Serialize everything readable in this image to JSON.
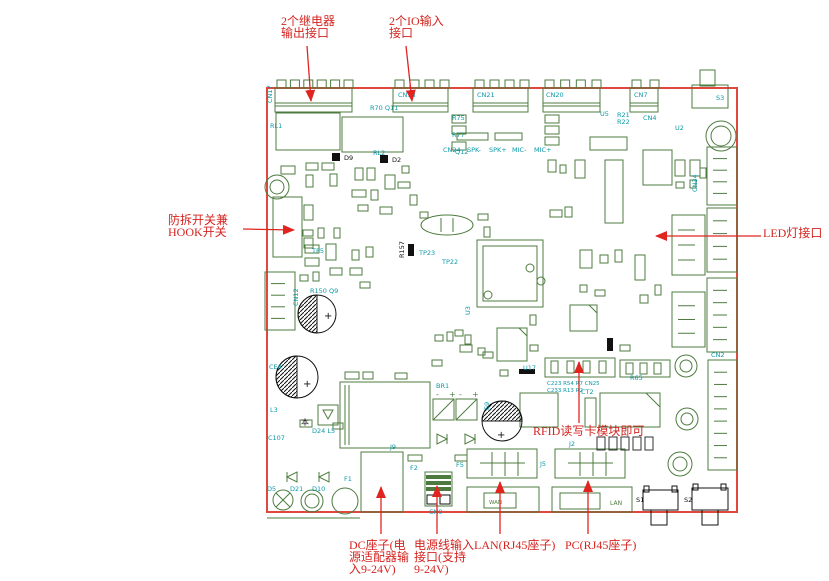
{
  "title": "PCB接口说明图",
  "colors": {
    "annotation_red": "#d42420",
    "board_outline_red": "#e0483e",
    "component_green": "#4d7b3f",
    "designator_cyan": "#0a98a8",
    "component_black": "#111111"
  },
  "annotations": [
    {
      "id": "relay-output",
      "lines": [
        "2个继电器",
        "输出接口"
      ],
      "x": 281,
      "y": 14,
      "arrow": {
        "x1": 307,
        "y1": 46,
        "x2": 311,
        "y2": 101
      }
    },
    {
      "id": "io-input",
      "lines": [
        "2个IO输入",
        "接口"
      ],
      "x": 389,
      "y": 14,
      "arrow": {
        "x1": 406,
        "y1": 46,
        "x2": 412,
        "y2": 101
      }
    },
    {
      "id": "tamper-hook-switch",
      "lines": [
        "防拆开关兼",
        "HOOK开关"
      ],
      "x": 168,
      "y": 213,
      "arrow": {
        "x1": 243,
        "y1": 229,
        "x2": 294,
        "y2": 230
      }
    },
    {
      "id": "led-port",
      "lines": [
        "LED灯接口"
      ],
      "x": 763,
      "y": 226,
      "arrow": {
        "x1": 761,
        "y1": 236,
        "x2": 656,
        "y2": 236
      }
    },
    {
      "id": "rfid-module",
      "lines": [
        "RFID读写卡模块即可"
      ],
      "x": 533,
      "y": 424,
      "arrow": {
        "x1": 579,
        "y1": 423,
        "x2": 579,
        "y2": 362
      }
    },
    {
      "id": "dc-jack",
      "lines": [
        "DC座子(电",
        "源适配器输",
        "入9-24V)"
      ],
      "x": 349,
      "y": 538,
      "arrow": {
        "x1": 381,
        "y1": 534,
        "x2": 381,
        "y2": 487
      }
    },
    {
      "id": "power-wire-input",
      "lines": [
        "电源线输入",
        "接口(支持",
        "9-24V)"
      ],
      "x": 414,
      "y": 538,
      "arrow": {
        "x1": 437,
        "y1": 534,
        "x2": 437,
        "y2": 486
      }
    },
    {
      "id": "lan-rj45",
      "lines": [
        "LAN(RJ45座子)"
      ],
      "x": 474,
      "y": 538,
      "arrow": {
        "x1": 500,
        "y1": 534,
        "x2": 500,
        "y2": 482
      }
    },
    {
      "id": "pc-rj45",
      "lines": [
        "PC(RJ45座子)"
      ],
      "x": 565,
      "y": 538,
      "arrow": {
        "x1": 588,
        "y1": 534,
        "x2": 588,
        "y2": 481
      }
    }
  ],
  "ref_labels": [
    {
      "t": "CN17",
      "x": 272,
      "y": 103,
      "r": -90
    },
    {
      "t": "CN18",
      "x": 398,
      "y": 97
    },
    {
      "t": "CN21",
      "x": 477,
      "y": 97
    },
    {
      "t": "CN20",
      "x": 546,
      "y": 97
    },
    {
      "t": "CN7",
      "x": 634,
      "y": 97
    },
    {
      "t": "S3",
      "x": 716,
      "y": 100
    },
    {
      "t": "R70 Q11",
      "x": 370,
      "y": 110
    },
    {
      "t": "RL1",
      "x": 270,
      "y": 128
    },
    {
      "t": "RL2",
      "x": 373,
      "y": 155
    },
    {
      "t": "R75",
      "x": 452,
      "y": 120
    },
    {
      "t": "R77",
      "x": 452,
      "y": 137
    },
    {
      "t": "Q12",
      "x": 455,
      "y": 154
    },
    {
      "t": "CN24",
      "x": 443,
      "y": 152
    },
    {
      "t": "SPK-",
      "x": 467,
      "y": 152
    },
    {
      "t": "SPK+",
      "x": 489,
      "y": 152
    },
    {
      "t": "MIC-",
      "x": 512,
      "y": 152
    },
    {
      "t": "MIC+",
      "x": 534,
      "y": 152
    },
    {
      "t": "U5",
      "x": 600,
      "y": 116
    },
    {
      "t": "R21",
      "x": 617,
      "y": 117
    },
    {
      "t": "R22",
      "x": 617,
      "y": 124
    },
    {
      "t": "CN4",
      "x": 643,
      "y": 120
    },
    {
      "t": "U2",
      "x": 675,
      "y": 130
    },
    {
      "t": "CN34",
      "x": 697,
      "y": 192,
      "r": -90
    },
    {
      "t": "TP5",
      "x": 312,
      "y": 253
    },
    {
      "t": "CN12",
      "x": 298,
      "y": 306,
      "r": -90
    },
    {
      "t": "R150 Q9",
      "x": 310,
      "y": 293
    },
    {
      "t": "CE4",
      "x": 269,
      "y": 369
    },
    {
      "t": "L3",
      "x": 270,
      "y": 412
    },
    {
      "t": "C107",
      "x": 268,
      "y": 440
    },
    {
      "t": "D24 L5",
      "x": 312,
      "y": 433
    },
    {
      "t": "D5",
      "x": 267,
      "y": 491
    },
    {
      "t": "D21",
      "x": 290,
      "y": 491
    },
    {
      "t": "D10",
      "x": 312,
      "y": 491
    },
    {
      "t": "F1",
      "x": 344,
      "y": 481
    },
    {
      "t": "U3",
      "x": 470,
      "y": 315,
      "r": -90
    },
    {
      "t": "TP22",
      "x": 442,
      "y": 264
    },
    {
      "t": "TP23",
      "x": 419,
      "y": 255
    },
    {
      "t": "R157",
      "x": 404,
      "y": 258,
      "r": -90,
      "c": "#111111"
    },
    {
      "t": "C223 R54 R7 CN25",
      "x": 547,
      "y": 385,
      "s": 5.5
    },
    {
      "t": "C233 R13 R2",
      "x": 547,
      "y": 392,
      "s": 5.5
    },
    {
      "t": "R65",
      "x": 630,
      "y": 380
    },
    {
      "t": "U17",
      "x": 523,
      "y": 370
    },
    {
      "t": "E9",
      "x": 489,
      "y": 410,
      "r": -90
    },
    {
      "t": "CT2",
      "x": 581,
      "y": 394
    },
    {
      "t": "BR1",
      "x": 436,
      "y": 388
    },
    {
      "t": "J2",
      "x": 569,
      "y": 446
    },
    {
      "t": "J5",
      "x": 540,
      "y": 466
    },
    {
      "t": "F2",
      "x": 410,
      "y": 470
    },
    {
      "t": "F5",
      "x": 456,
      "y": 467
    },
    {
      "t": "J9",
      "x": 390,
      "y": 449
    },
    {
      "t": "CN9",
      "x": 429,
      "y": 514
    },
    {
      "t": "CN2",
      "x": 711,
      "y": 357
    },
    {
      "t": "WAN",
      "x": 489,
      "y": 504,
      "c": "#4d7b3f",
      "s": 5.5
    },
    {
      "t": "LAN",
      "x": 610,
      "y": 505,
      "c": "#4d7b3f",
      "s": 6
    },
    {
      "t": "S1",
      "x": 636,
      "y": 502,
      "c": "#111111"
    },
    {
      "t": "S2",
      "x": 684,
      "y": 502,
      "c": "#111111"
    },
    {
      "t": "D9",
      "x": 344,
      "y": 160,
      "c": "#111111"
    },
    {
      "t": "D2",
      "x": 392,
      "y": 162,
      "c": "#111111"
    },
    {
      "t": "本",
      "x": 301,
      "y": 425,
      "c": "#111111",
      "s": 8
    }
  ],
  "battery_marks": [
    "-",
    "+",
    "-",
    "+"
  ],
  "board": {
    "top_connectors": [
      {
        "x": 275,
        "w": 77,
        "teeth": 6
      },
      {
        "x": 393,
        "w": 55,
        "teeth": 4
      },
      {
        "x": 473,
        "w": 55,
        "teeth": 4
      },
      {
        "x": 543,
        "w": 57,
        "teeth": 4
      },
      {
        "x": 630,
        "w": 28,
        "teeth": 2
      }
    ],
    "side_connectors": [
      {
        "x": 707,
        "y": 147,
        "w": 30,
        "h": 58,
        "pins": 4
      },
      {
        "x": 707,
        "y": 208,
        "w": 30,
        "h": 64,
        "pins": 4
      },
      {
        "x": 672,
        "y": 215,
        "w": 33,
        "h": 60,
        "pins": 3
      },
      {
        "x": 707,
        "y": 278,
        "w": 30,
        "h": 74,
        "pins": 5
      },
      {
        "x": 708,
        "y": 360,
        "w": 29,
        "h": 110,
        "pins": 8
      },
      {
        "x": 672,
        "y": 292,
        "w": 33,
        "h": 55,
        "pins": 3
      },
      {
        "x": 265,
        "y": 272,
        "w": 30,
        "h": 58,
        "pins": 4
      }
    ],
    "passives": [
      [
        306,
        163,
        12,
        7
      ],
      [
        322,
        163,
        12,
        7
      ],
      [
        306,
        175,
        7,
        12
      ],
      [
        330,
        174,
        7,
        12
      ],
      [
        281,
        166,
        14,
        8
      ],
      [
        355,
        168,
        8,
        12
      ],
      [
        367,
        168,
        8,
        12
      ],
      [
        352,
        190,
        14,
        7
      ],
      [
        371,
        190,
        7,
        10
      ],
      [
        385,
        175,
        10,
        14
      ],
      [
        402,
        166,
        7,
        7
      ],
      [
        398,
        182,
        12,
        6
      ],
      [
        410,
        195,
        7,
        10
      ],
      [
        358,
        205,
        10,
        6
      ],
      [
        380,
        207,
        12,
        7
      ],
      [
        420,
        212,
        8,
        6
      ],
      [
        478,
        214,
        10,
        6
      ],
      [
        484,
        227,
        6,
        10
      ],
      [
        303,
        230,
        10,
        6
      ],
      [
        318,
        228,
        6,
        10
      ],
      [
        334,
        228,
        6,
        10
      ],
      [
        305,
        245,
        14,
        8
      ],
      [
        305,
        258,
        14,
        8
      ],
      [
        326,
        244,
        10,
        16
      ],
      [
        300,
        275,
        8,
        6
      ],
      [
        313,
        272,
        6,
        9
      ],
      [
        330,
        268,
        12,
        7
      ],
      [
        352,
        250,
        7,
        10
      ],
      [
        366,
        247,
        7,
        10
      ],
      [
        350,
        268,
        12,
        7
      ],
      [
        360,
        282,
        10,
        6
      ],
      [
        455,
        330,
        8,
        6
      ],
      [
        465,
        335,
        6,
        9
      ],
      [
        483,
        352,
        10,
        6
      ],
      [
        530,
        315,
        6,
        10
      ],
      [
        548,
        160,
        8,
        12
      ],
      [
        560,
        165,
        6,
        8
      ],
      [
        575,
        160,
        10,
        18
      ],
      [
        550,
        210,
        12,
        7
      ],
      [
        565,
        207,
        7,
        10
      ],
      [
        580,
        250,
        12,
        18
      ],
      [
        600,
        255,
        8,
        8
      ],
      [
        615,
        250,
        7,
        12
      ],
      [
        635,
        255,
        10,
        25
      ],
      [
        580,
        285,
        7,
        7
      ],
      [
        595,
        290,
        10,
        6
      ],
      [
        640,
        295,
        8,
        8
      ],
      [
        655,
        285,
        6,
        10
      ],
      [
        435,
        335,
        8,
        6
      ],
      [
        447,
        332,
        6,
        9
      ],
      [
        460,
        345,
        12,
        7
      ],
      [
        478,
        348,
        7,
        7
      ],
      [
        432,
        360,
        10,
        6
      ],
      [
        500,
        370,
        8,
        6
      ],
      [
        300,
        420,
        12,
        7
      ],
      [
        333,
        423,
        10,
        6
      ],
      [
        408,
        455,
        14,
        6
      ],
      [
        455,
        455,
        12,
        6
      ],
      [
        675,
        160,
        10,
        16
      ],
      [
        690,
        160,
        10,
        16
      ],
      [
        676,
        182,
        8,
        6
      ],
      [
        690,
        180,
        6,
        8
      ],
      [
        700,
        168,
        6,
        10
      ],
      [
        530,
        345,
        8,
        6
      ],
      [
        620,
        345,
        10,
        6
      ],
      [
        457,
        133,
        31,
        7
      ],
      [
        495,
        133,
        27,
        7
      ],
      [
        452,
        115,
        14,
        8
      ],
      [
        452,
        126,
        14,
        8
      ],
      [
        452,
        142,
        14,
        8
      ],
      [
        545,
        115,
        14,
        8
      ],
      [
        545,
        126,
        14,
        8
      ],
      [
        545,
        137,
        14,
        8
      ],
      [
        590,
        137,
        37,
        13
      ],
      [
        643,
        150,
        29,
        35
      ],
      [
        605,
        160,
        18,
        63
      ],
      [
        345,
        372,
        14,
        7
      ],
      [
        363,
        372,
        10,
        7
      ],
      [
        395,
        373,
        12,
        6
      ]
    ],
    "dark_passives": [
      [
        597,
        437,
        8,
        13
      ],
      [
        609,
        437,
        8,
        13
      ],
      [
        621,
        437,
        8,
        13
      ],
      [
        633,
        437,
        8,
        13
      ],
      [
        645,
        437,
        8,
        13
      ]
    ]
  }
}
